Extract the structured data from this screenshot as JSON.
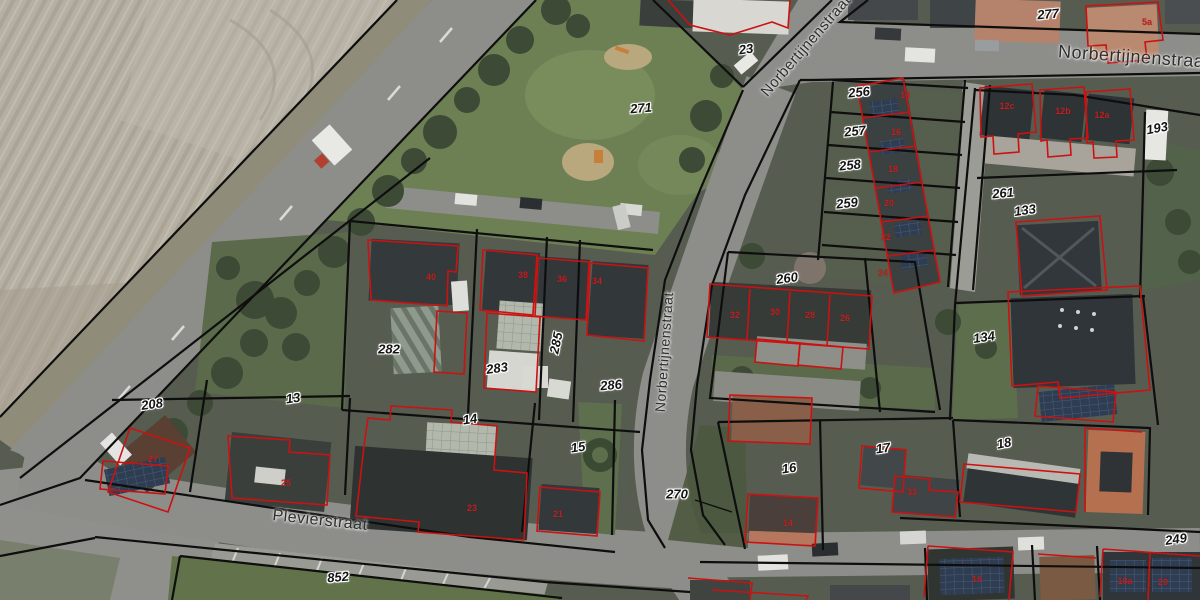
{
  "map": {
    "description": "Aerial cadastral map with parcel boundaries and building outlines",
    "street_labels": [
      {
        "id": "norbertijnenstraat-diagonal",
        "text": "Norbertijnenstraat",
        "x": 806,
        "y": 46,
        "rotation": -49,
        "size": 15
      },
      {
        "id": "norbertijnenstraat-top-right",
        "text": "Norbertijnenstraat",
        "x": 1134,
        "y": 57,
        "rotation": 4,
        "size": 18
      },
      {
        "id": "norbertijnenstraat-central",
        "text": "Norbertijnenstraat",
        "x": 664,
        "y": 352,
        "rotation": -86,
        "size": 14
      },
      {
        "id": "plevierstraat",
        "text": "Plevierstraat",
        "x": 320,
        "y": 521,
        "rotation": 6,
        "size": 16
      }
    ],
    "parcel_labels": [
      {
        "text": "23",
        "x": 746,
        "y": 49,
        "rotation": -8
      },
      {
        "text": "271",
        "x": 641,
        "y": 108,
        "rotation": -5
      },
      {
        "text": "277",
        "x": 1048,
        "y": 14,
        "rotation": -5
      },
      {
        "text": "256",
        "x": 859,
        "y": 92,
        "rotation": -6
      },
      {
        "text": "257",
        "x": 855,
        "y": 131,
        "rotation": -6
      },
      {
        "text": "258",
        "x": 850,
        "y": 165,
        "rotation": -6
      },
      {
        "text": "259",
        "x": 847,
        "y": 203,
        "rotation": -6
      },
      {
        "text": "260",
        "x": 787,
        "y": 278,
        "rotation": -8
      },
      {
        "text": "261",
        "x": 1003,
        "y": 193,
        "rotation": -5
      },
      {
        "text": "133",
        "x": 1025,
        "y": 210,
        "rotation": -8
      },
      {
        "text": "193",
        "x": 1157,
        "y": 128,
        "rotation": -10
      },
      {
        "text": "134",
        "x": 984,
        "y": 337,
        "rotation": -8
      },
      {
        "text": "282",
        "x": 389,
        "y": 349,
        "rotation": 0
      },
      {
        "text": "283",
        "x": 497,
        "y": 368,
        "rotation": -8
      },
      {
        "text": "285",
        "x": 556,
        "y": 343,
        "rotation": -78
      },
      {
        "text": "286",
        "x": 611,
        "y": 385,
        "rotation": -5
      },
      {
        "text": "208",
        "x": 152,
        "y": 404,
        "rotation": -8
      },
      {
        "text": "13",
        "x": 293,
        "y": 398,
        "rotation": -8
      },
      {
        "text": "14",
        "x": 470,
        "y": 419,
        "rotation": -8
      },
      {
        "text": "15",
        "x": 578,
        "y": 447,
        "rotation": -8
      },
      {
        "text": "16",
        "x": 789,
        "y": 468,
        "rotation": -8
      },
      {
        "text": "17",
        "x": 883,
        "y": 448,
        "rotation": -8
      },
      {
        "text": "18",
        "x": 1004,
        "y": 443,
        "rotation": -10
      },
      {
        "text": "270",
        "x": 677,
        "y": 494,
        "rotation": 0
      },
      {
        "text": "249",
        "x": 1176,
        "y": 539,
        "rotation": -8
      },
      {
        "text": "852",
        "x": 338,
        "y": 577,
        "rotation": -5
      }
    ],
    "house_number_labels": [
      {
        "text": "5a",
        "x": 1147,
        "y": 22
      },
      {
        "text": "12c",
        "x": 1007,
        "y": 106
      },
      {
        "text": "12b",
        "x": 1063,
        "y": 111
      },
      {
        "text": "12a",
        "x": 1102,
        "y": 115
      },
      {
        "text": "14",
        "x": 905,
        "y": 95
      },
      {
        "text": "16",
        "x": 896,
        "y": 132
      },
      {
        "text": "18",
        "x": 893,
        "y": 169
      },
      {
        "text": "20",
        "x": 889,
        "y": 203
      },
      {
        "text": "22",
        "x": 886,
        "y": 237
      },
      {
        "text": "24",
        "x": 883,
        "y": 273
      },
      {
        "text": "32",
        "x": 735,
        "y": 315
      },
      {
        "text": "30",
        "x": 775,
        "y": 312
      },
      {
        "text": "28",
        "x": 810,
        "y": 315
      },
      {
        "text": "26",
        "x": 845,
        "y": 318
      },
      {
        "text": "40",
        "x": 431,
        "y": 277
      },
      {
        "text": "38",
        "x": 523,
        "y": 275
      },
      {
        "text": "36",
        "x": 562,
        "y": 279
      },
      {
        "text": "34",
        "x": 597,
        "y": 281
      },
      {
        "text": "27",
        "x": 153,
        "y": 459
      },
      {
        "text": "25",
        "x": 286,
        "y": 483
      },
      {
        "text": "23",
        "x": 472,
        "y": 508
      },
      {
        "text": "21",
        "x": 558,
        "y": 514
      },
      {
        "text": "33",
        "x": 912,
        "y": 492
      },
      {
        "text": "14",
        "x": 788,
        "y": 523
      },
      {
        "text": "16",
        "x": 977,
        "y": 579
      },
      {
        "text": "18a",
        "x": 1125,
        "y": 581
      },
      {
        "text": "20",
        "x": 1163,
        "y": 582
      }
    ],
    "colors": {
      "parcel_line": "#0e0e0e",
      "building_outline": "#cc1111",
      "parcel_label_text": "#141414",
      "street_label_text": "#2f2f2f",
      "house_number_text": "#c21f1f"
    }
  }
}
